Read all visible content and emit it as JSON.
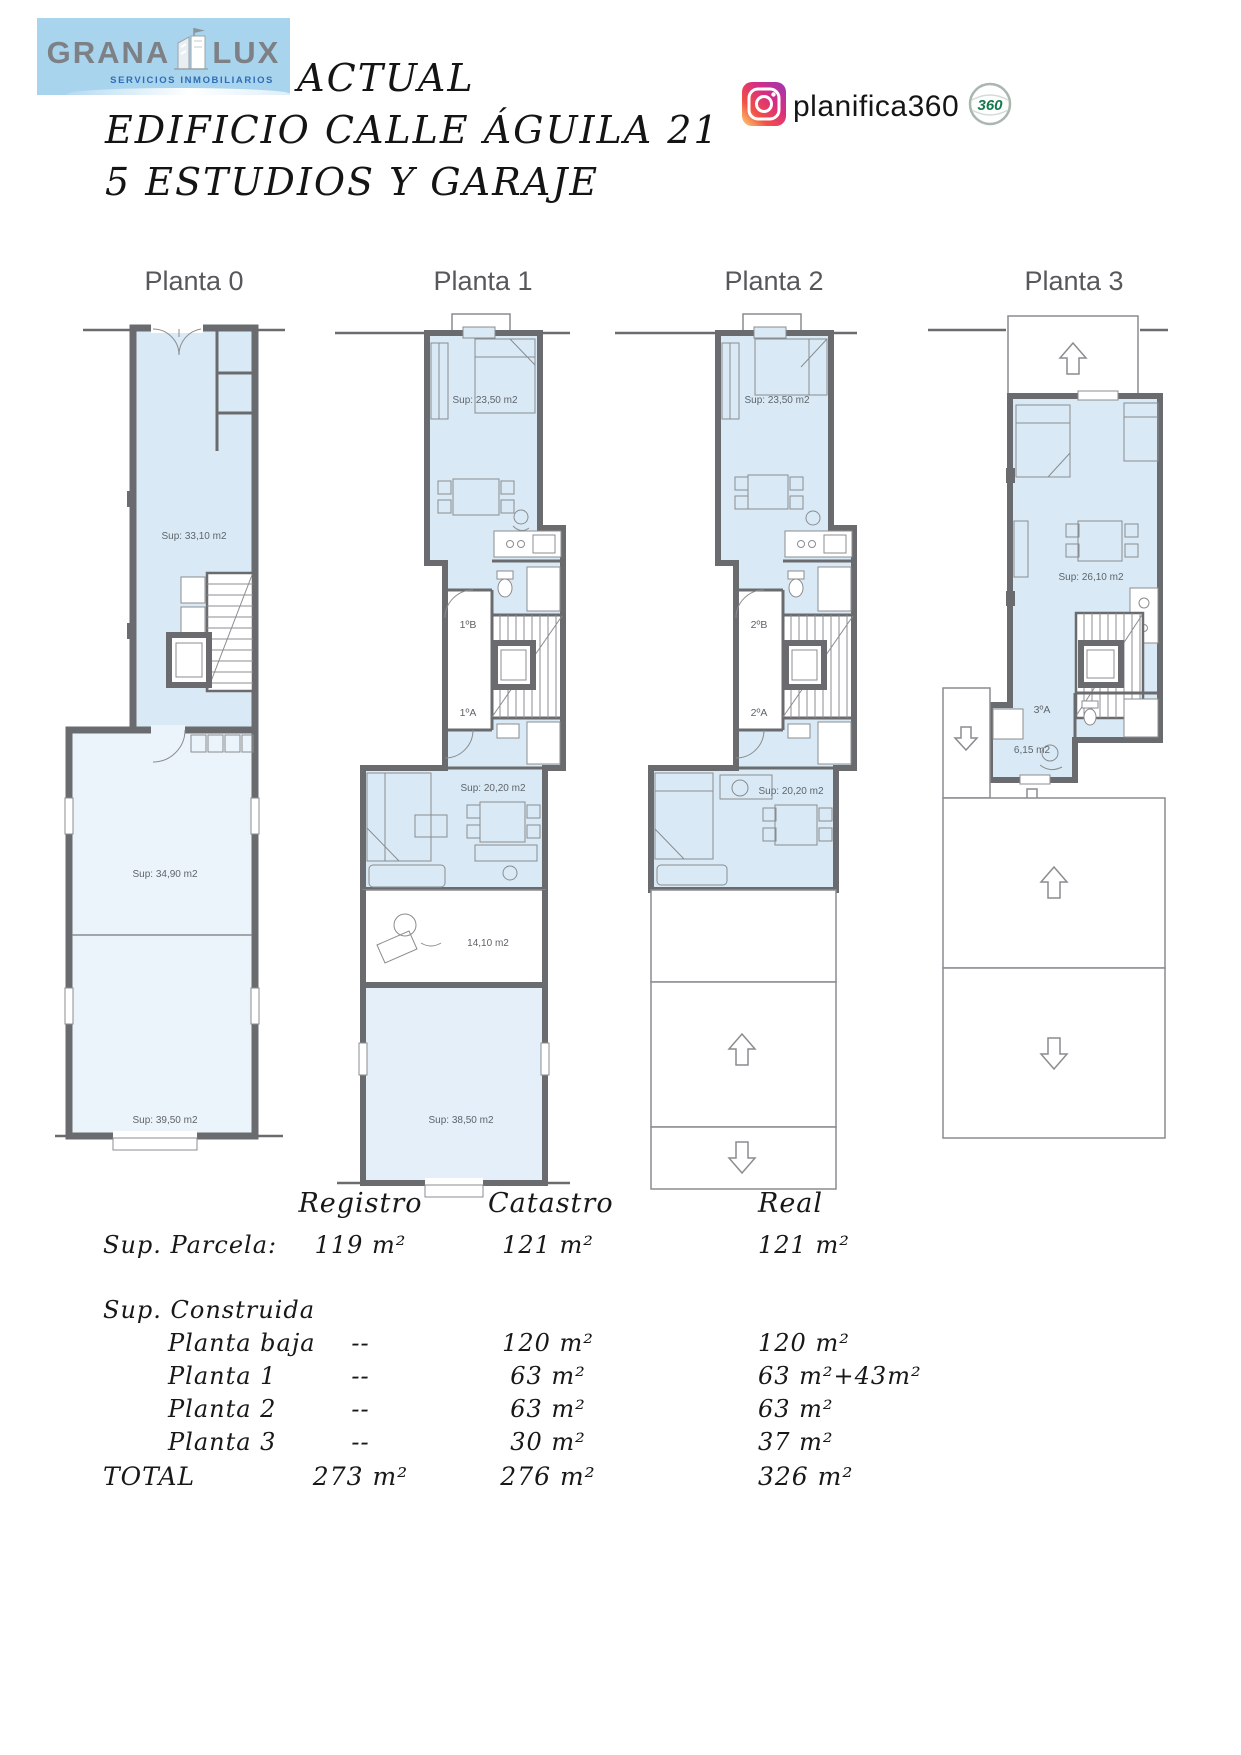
{
  "branding": {
    "logo": {
      "name_left": "GRANA",
      "name_right": "LUX",
      "tagline": "SERVICIOS INMOBILIARIOS"
    },
    "instagram": {
      "handle": "planifica360",
      "badge": "360"
    },
    "colors": {
      "logo_bg": "#a9d4ee",
      "tagline_blue": "#2f6db5",
      "wall_gray": "#6a6b6e",
      "room_fill": "#d9eaf6",
      "room_fill_light": "#ecf4fb",
      "badge_green": "#147a4e"
    }
  },
  "title": {
    "line1": "ESTADO ACTUAL",
    "line2": "EDIFICIO CALLE ÁGUILA 21",
    "line3": "5 ESTUDIOS Y GARAJE"
  },
  "plans": {
    "p0": {
      "name": "Planta 0",
      "area_corridor": "Sup: 33,10 m2",
      "area_mid": "Sup: 34,90 m2",
      "area_bottom": "Sup: 39,50 m2"
    },
    "p1": {
      "name": "Planta 1",
      "area_top": "Sup: 23,50 m2",
      "unit_b": "1ºB",
      "unit_a": "1ºA",
      "area_studio": "Sup: 20,20 m2",
      "area_patio": "14,10 m2",
      "area_garage": "Sup: 38,50 m2"
    },
    "p2": {
      "name": "Planta 2",
      "area_top": "Sup: 23,50 m2",
      "unit_b": "2ºB",
      "unit_a": "2ºA",
      "area_studio": "Sup: 20,20 m2"
    },
    "p3": {
      "name": "Planta 3",
      "area_main": "Sup: 26,10 m2",
      "unit_a": "3ºA",
      "area_small": "6,15 m2"
    }
  },
  "table": {
    "columns": [
      "Registro",
      "Catastro",
      "Real"
    ],
    "rows": [
      {
        "label": "Sup. Parcela:",
        "registro": "119 m²",
        "catastro": "121 m²",
        "real": "121 m²"
      },
      {
        "label": "Sup. Construida",
        "registro": "",
        "catastro": "",
        "real": ""
      },
      {
        "label": "Planta baja",
        "registro": "--",
        "catastro": "120 m²",
        "real": "120 m²"
      },
      {
        "label": "Planta 1",
        "registro": "--",
        "catastro": "63 m²",
        "real": "63 m²+43m²"
      },
      {
        "label": "Planta 2",
        "registro": "--",
        "catastro": "63 m²",
        "real": "63 m²"
      },
      {
        "label": "Planta 3",
        "registro": "--",
        "catastro": "30 m²",
        "real": "37 m²"
      },
      {
        "label": "TOTAL",
        "registro": "273 m²",
        "catastro": "276 m²",
        "real": "326 m²"
      }
    ]
  }
}
